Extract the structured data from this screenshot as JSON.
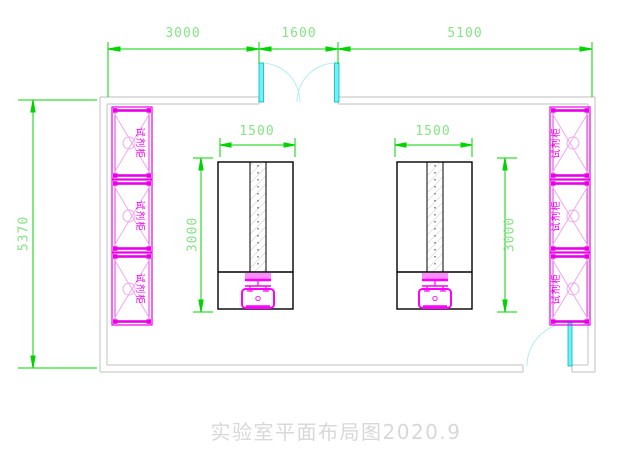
{
  "title": "实验室平面布局图2020.9",
  "dimensions": {
    "top": [
      {
        "label": "3000"
      },
      {
        "label": "1600"
      },
      {
        "label": "5100"
      }
    ],
    "room_height": {
      "label": "5370"
    },
    "bench_width": {
      "label": "1500"
    },
    "bench_depth": {
      "label": "3000"
    }
  },
  "cabinets": {
    "label": "试剂柜",
    "left_count": 3,
    "right_count": 3
  },
  "colors": {
    "dimension_green": "#00d400",
    "dimension_text_green": "#86e386",
    "cabinet_magenta": "#e800e8",
    "sink_magenta": "#ff00ff",
    "door_cyan": "#00e0e0",
    "wall_gray": "#cccccc",
    "title_gray": "#d8d8d8"
  }
}
